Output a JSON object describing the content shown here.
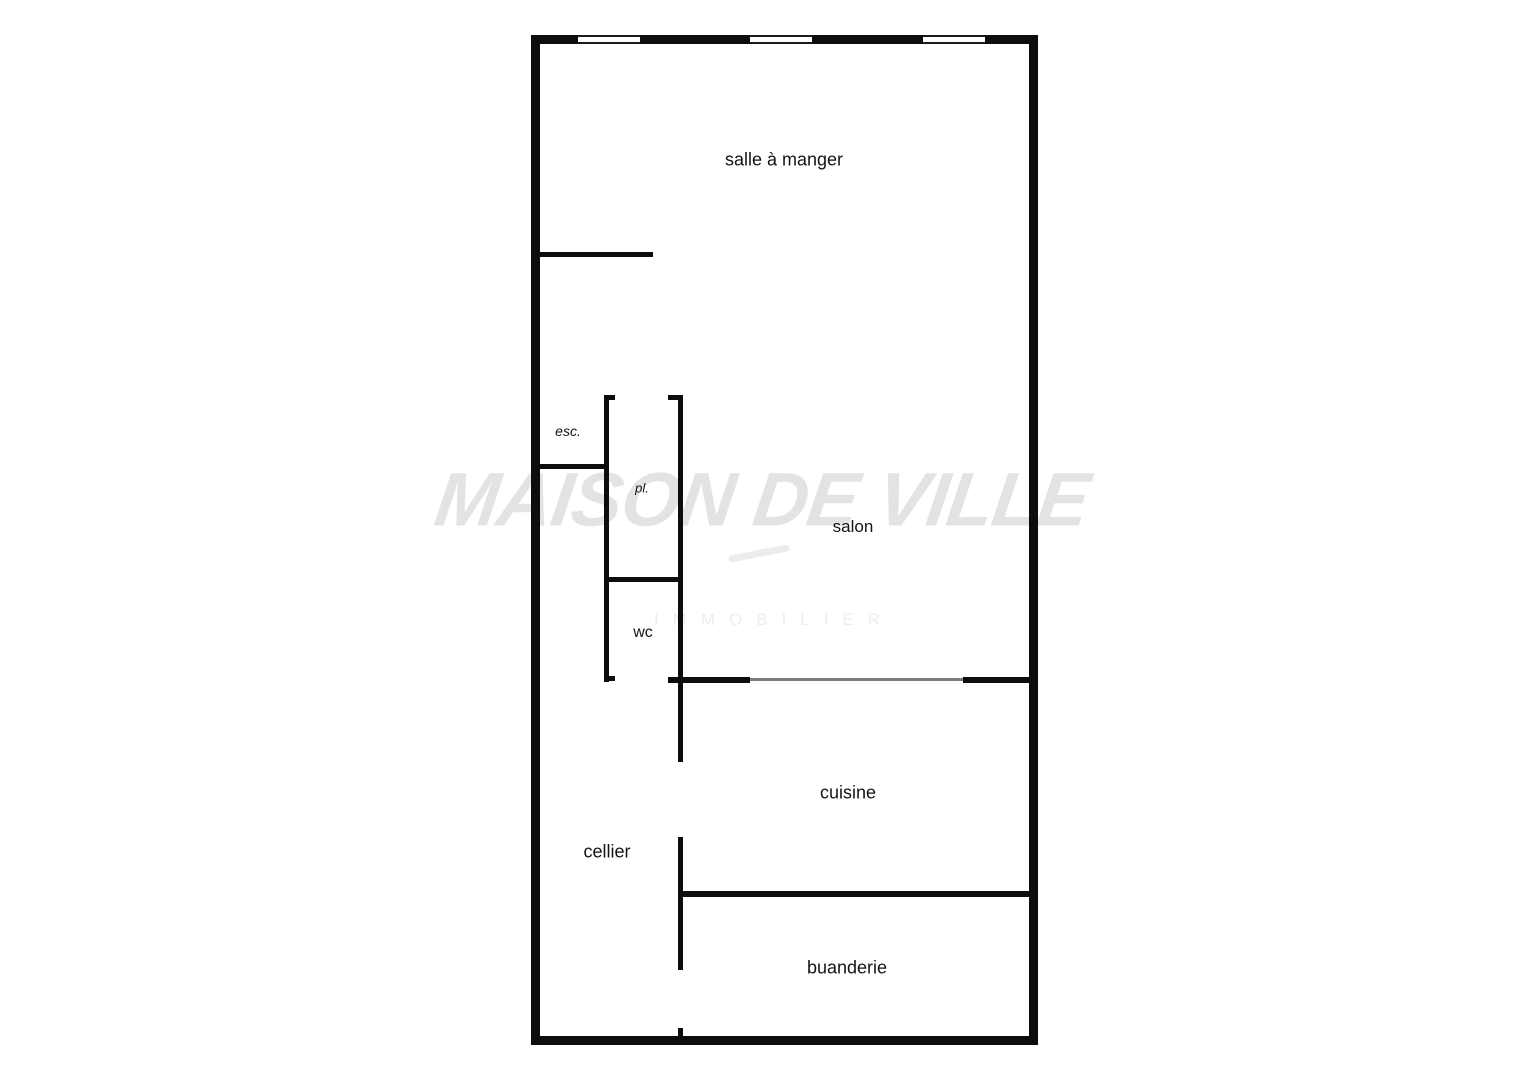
{
  "page": {
    "background_color": "#ffffff"
  },
  "watermark": {
    "title": "MAISON DE VILLE",
    "subtitle": "IMMOBILIER",
    "title_color": "#e3e3e3",
    "subtitle_color": "#ededed"
  },
  "floorplan": {
    "wall_color": "#0d0d0d",
    "opening_line_color": "#7d7d7d",
    "window_count": 3,
    "rooms": [
      {
        "id": "salle-a-manger",
        "label": "salle à manger"
      },
      {
        "id": "esc",
        "label": "esc."
      },
      {
        "id": "pl",
        "label": "pl."
      },
      {
        "id": "salon",
        "label": "salon"
      },
      {
        "id": "wc",
        "label": "wc"
      },
      {
        "id": "cuisine",
        "label": "cuisine"
      },
      {
        "id": "cellier",
        "label": "cellier"
      },
      {
        "id": "buanderie",
        "label": "buanderie"
      }
    ]
  }
}
